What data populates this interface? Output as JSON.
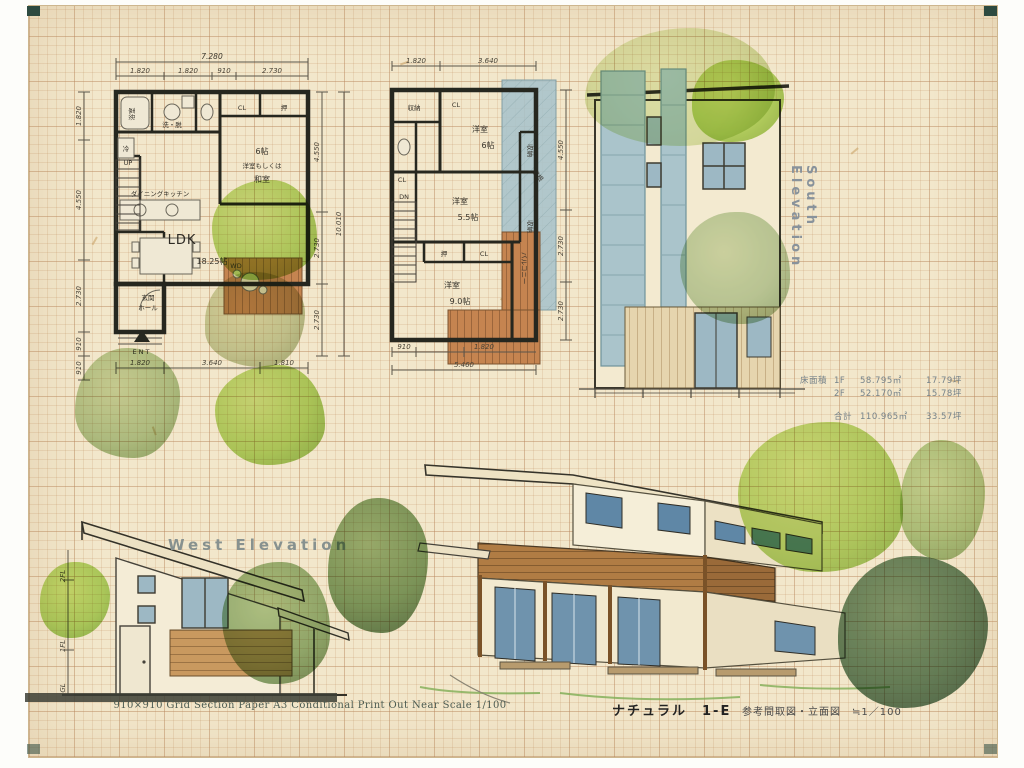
{
  "palette": {
    "paper": "#f2e7cb",
    "grid_line": "#c79a6e",
    "wall_ink": "#26271f",
    "deck_wood": "#c08049",
    "roof_blue": "#a9c4cc",
    "tree_bright": "#a6d14e",
    "tree_sage": "#a5c291",
    "pencil_gray": "#6a665a"
  },
  "footer": {
    "left": "910×910 Grid Section Paper A3 Conditional Print Out  Near Scale 1/100",
    "product": "ナチュラル　1-E",
    "caption": "参考間取図・立面図　≒1／100"
  },
  "area_table": {
    "heading": "床面積",
    "rows": [
      {
        "floor": "1F",
        "area_m2": "58.795㎡",
        "area_tsubo": "17.79坪"
      },
      {
        "floor": "2F",
        "area_m2": "52.170㎡",
        "area_tsubo": "15.78坪"
      }
    ],
    "total": {
      "label": "合計",
      "area_m2": "110.965㎡",
      "area_tsubo": "33.57坪"
    }
  },
  "plan_1f": {
    "dim_top_total": "7.280",
    "dim_top": [
      "1.820",
      "1.820",
      "910",
      "2.730"
    ],
    "dim_bottom": [
      "1.820",
      "3.640",
      "1.810"
    ],
    "dim_left": [
      "1.820",
      "4.550",
      "2.730",
      "910",
      "910"
    ],
    "dim_right": [
      "4.550",
      "2.730",
      "2.730"
    ],
    "dim_right_total": "10.010",
    "labels": {
      "bath": "浴室",
      "wash": "洗・脱",
      "fridge": "冷",
      "closet": "CL",
      "oshiire": "押",
      "room6_size": "6帖",
      "room6_l1": "洋室もしくは",
      "room6_l2": "和室",
      "dk": "ダイニングキッチン",
      "ldk": "LDK",
      "ldk_size": "18.25帖",
      "up": "UP",
      "entrance": "玄関",
      "hall": "ホール",
      "ent": "ENT",
      "wood_deck": "WD"
    }
  },
  "plan_2f": {
    "dim_top": [
      "1.820",
      "3.640"
    ],
    "dim_bottom": [
      "910",
      "1.820"
    ],
    "dim_bottom_total": "5.460",
    "dim_right": [
      "4.550",
      "2.730",
      "2.730"
    ],
    "labels": {
      "storage": "収納",
      "room6": "洋室",
      "room6_size": "6帖",
      "room55": "洋室",
      "room55_size": "5.5帖",
      "room9": "洋室",
      "room9_size": "9.0帖",
      "closet_a": "CL",
      "closet_b": "CL",
      "closet_c": "CL",
      "oshiire": "押",
      "dn": "DN",
      "balcony": "バルコニー",
      "roof": "屋根",
      "storage_r1": "収納",
      "storage_r2": "収納"
    }
  },
  "south_elevation": {
    "title": "South Elevation"
  },
  "west_elevation": {
    "title": "West Elevation",
    "levels": [
      "2FL",
      "1FL",
      "GL"
    ]
  }
}
